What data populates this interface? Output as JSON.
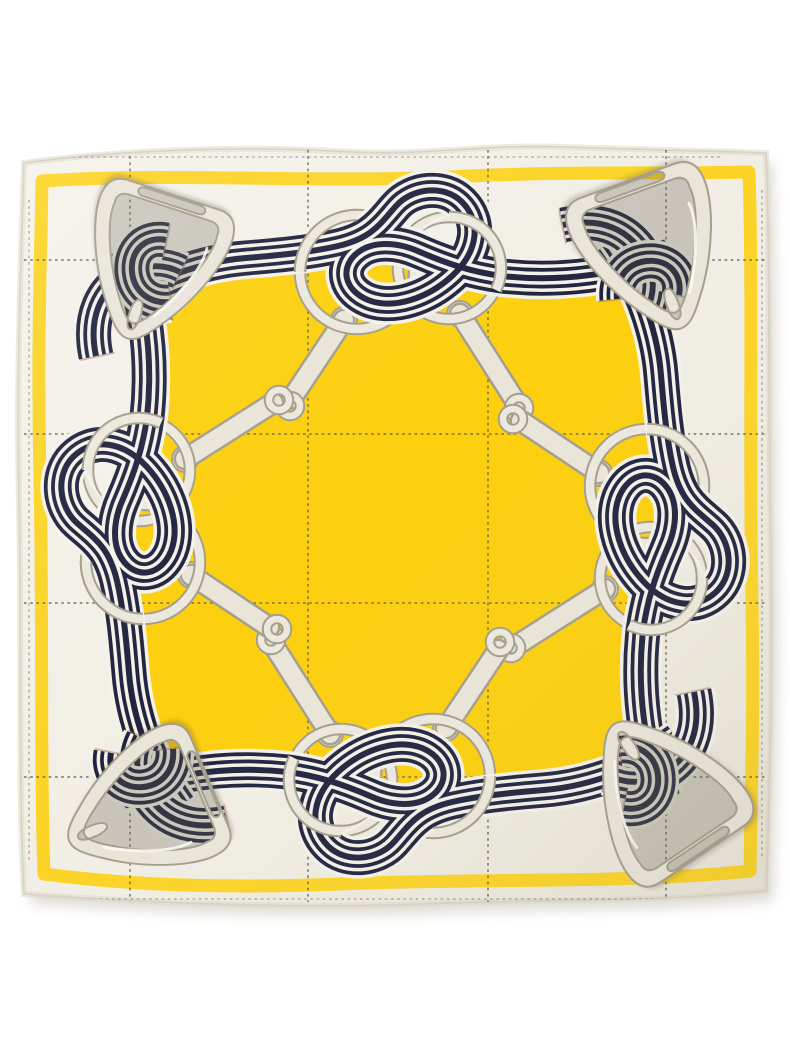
{
  "image": {
    "type": "product-photo",
    "subject": "Square silk twill scarf, flat lay on a white background",
    "motif": "Equestrian print: navy striped ribbon knotted through interlocked snaffle rings, bit shanks linked at the center diamond, and a stirrup at each corner",
    "field_shape": "yellow center square inside a cream border with a yellow frame line and dashed stitch grid"
  },
  "palette": {
    "photo_bg": "#ffffff",
    "scarf_base": "#f2efe6",
    "scarf_base_deep": "#eae6d9",
    "hem_line": "#cfc9ba",
    "hem_roll": "#ded9cb",
    "band_yellow": "#fcd426",
    "field_yellow": "#fcd00e",
    "stitch": "#5f5945",
    "ribbon_cream": "#f4f1e8",
    "ribbon_navy": "#20243f",
    "fringe_red": "#8c4a3f",
    "fringe_teal": "#4d837b",
    "hw_fill": "#e9e5d9",
    "hw_body": "#ece8dd",
    "hw_outline": "#a59e8c",
    "hw_highlight": "#fbfaf4",
    "hw_shade": "rgba(95,88,72,0.28)",
    "drop_shadow": "#a29a84"
  },
  "ribbon_spec": {
    "total_width": 42,
    "layer_widths": [
      42,
      35,
      27.5,
      20.5,
      13,
      6
    ],
    "layer_roles": [
      "cream",
      "navy",
      "cream",
      "navy",
      "cream",
      "navy"
    ],
    "fringe_width": 35
  },
  "layout": {
    "scarf_bounds": {
      "left": 20,
      "top": 146,
      "right": 770,
      "bottom": 906
    },
    "center": {
      "x": 395,
      "y": 524
    },
    "field_bounds": {
      "left": 135,
      "top": 264,
      "right": 659,
      "bottom": 783
    },
    "grid_vertical_x": [
      130,
      308,
      488,
      666
    ],
    "grid_horizontal_y": [
      260,
      434,
      603,
      777
    ],
    "rings_per_side": 2,
    "stirrup_count": 4,
    "bit_arm_count": 8
  }
}
